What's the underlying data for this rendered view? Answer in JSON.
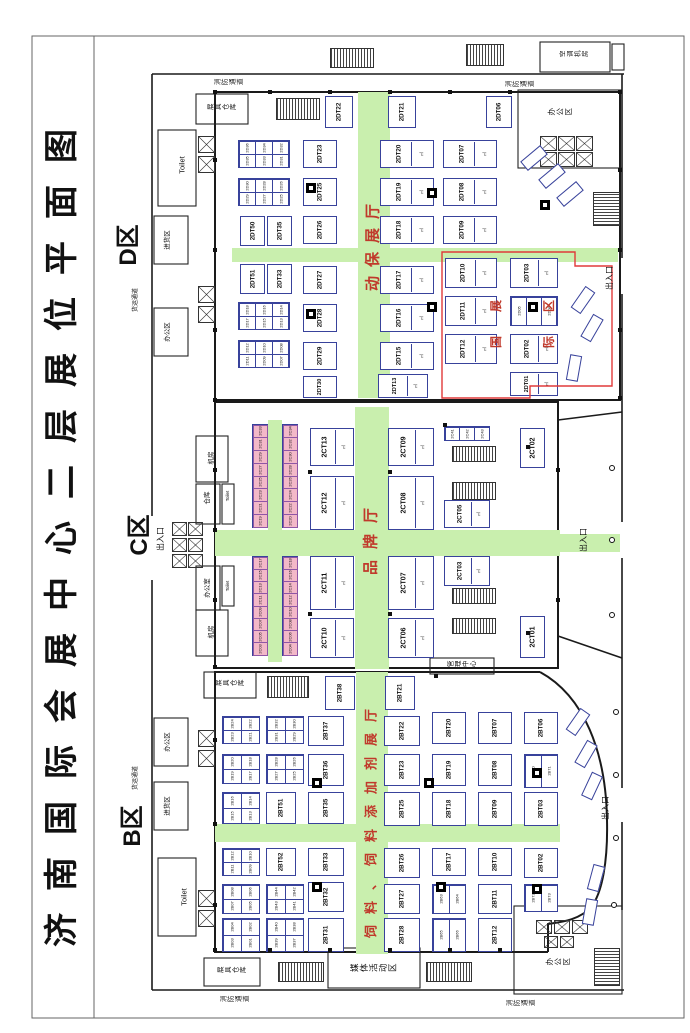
{
  "title": "济南国际会展中心二层展位平面图",
  "zones": {
    "d": {
      "label": "D区",
      "hall": "动保展厅"
    },
    "c": {
      "label": "C区",
      "hall": "品牌厅"
    },
    "b": {
      "label": "B区",
      "hall": "饲料、饲料添加剂展厅"
    },
    "international": {
      "label": "国际展区"
    }
  },
  "colors": {
    "aisle_green": "#c9efae",
    "booth_border": "#38429b",
    "hall_text_red": "#c0392b",
    "intl_box_red": "#e03a3a",
    "mini_pink": "#f3b8c8"
  },
  "booths": [
    [
      "2DT22",
      325,
      96,
      28,
      32
    ],
    [
      "2DT21",
      388,
      96,
      28,
      32
    ],
    [
      "2DT06",
      486,
      96,
      26,
      32
    ],
    [
      "2DT50",
      240,
      216,
      25,
      30
    ],
    [
      "2DT35",
      267,
      216,
      25,
      30
    ],
    [
      "2DT51",
      240,
      264,
      25,
      30
    ],
    [
      "2DT33",
      267,
      264,
      25,
      30
    ],
    [
      "2DT23",
      303,
      140,
      34,
      28
    ],
    [
      "2DT25",
      303,
      178,
      34,
      28
    ],
    [
      "2DT26",
      303,
      216,
      34,
      28
    ],
    [
      "2DT27",
      303,
      266,
      34,
      28
    ],
    [
      "2DT28",
      303,
      304,
      34,
      28
    ],
    [
      "2DT29",
      303,
      342,
      34,
      28
    ],
    [
      "2DT30",
      303,
      376,
      34,
      22
    ],
    [
      "2DT20",
      380,
      140,
      54,
      28
    ],
    [
      "2DT19",
      380,
      178,
      54,
      28
    ],
    [
      "2DT18",
      380,
      216,
      54,
      28
    ],
    [
      "2DT17",
      380,
      266,
      54,
      28
    ],
    [
      "2DT16",
      380,
      304,
      54,
      28
    ],
    [
      "2DT15",
      380,
      342,
      54,
      28
    ],
    [
      "2DT13",
      378,
      374,
      50,
      24
    ],
    [
      "2DT07",
      443,
      140,
      54,
      28
    ],
    [
      "2DT08",
      443,
      178,
      54,
      28
    ],
    [
      "2DT09",
      443,
      216,
      54,
      28
    ],
    [
      "2DT10",
      445,
      258,
      52,
      30
    ],
    [
      "2DT11",
      445,
      296,
      52,
      30
    ],
    [
      "2DT12",
      445,
      334,
      52,
      30
    ],
    [
      "2DT03",
      510,
      258,
      48,
      30
    ],
    [
      "2DT02",
      510,
      334,
      48,
      30
    ],
    [
      "2DT01",
      510,
      372,
      48,
      24
    ],
    [
      "2CT13",
      310,
      428,
      44,
      38
    ],
    [
      "2CT12",
      310,
      476,
      44,
      54
    ],
    [
      "2CT11",
      310,
      556,
      44,
      54
    ],
    [
      "2CT10",
      310,
      618,
      44,
      40
    ],
    [
      "2CT09",
      388,
      428,
      46,
      38
    ],
    [
      "2CT08",
      388,
      476,
      46,
      54
    ],
    [
      "2CT07",
      388,
      556,
      46,
      54
    ],
    [
      "2CT06",
      388,
      618,
      46,
      40
    ],
    [
      "2CT05",
      444,
      500,
      46,
      28
    ],
    [
      "2CT03",
      444,
      556,
      46,
      30
    ],
    [
      "2CT02",
      520,
      428,
      25,
      40
    ],
    [
      "2CT01",
      520,
      616,
      25,
      42
    ],
    [
      "2BT38",
      325,
      676,
      30,
      34
    ],
    [
      "2BT21",
      385,
      676,
      30,
      34
    ],
    [
      "2BT37",
      308,
      716,
      36,
      30
    ],
    [
      "2BT36",
      308,
      754,
      36,
      32
    ],
    [
      "2BT35",
      308,
      792,
      36,
      32
    ],
    [
      "2BT33",
      308,
      848,
      36,
      28
    ],
    [
      "2BT32",
      308,
      882,
      36,
      30
    ],
    [
      "2BT31",
      308,
      918,
      36,
      34
    ],
    [
      "2BT51",
      266,
      792,
      30,
      32
    ],
    [
      "2BT52",
      266,
      848,
      30,
      28
    ],
    [
      "2BT22",
      384,
      716,
      36,
      30
    ],
    [
      "2BT23",
      384,
      754,
      36,
      32
    ],
    [
      "2BT25",
      384,
      792,
      36,
      34
    ],
    [
      "2BT26",
      384,
      848,
      36,
      30
    ],
    [
      "2BT27",
      384,
      884,
      36,
      30
    ],
    [
      "2BT28",
      384,
      918,
      36,
      34
    ],
    [
      "2BT20",
      432,
      712,
      34,
      32
    ],
    [
      "2BT19",
      432,
      754,
      34,
      32
    ],
    [
      "2BT18",
      432,
      792,
      34,
      34
    ],
    [
      "2BT17",
      432,
      848,
      34,
      28
    ],
    [
      "2BT07",
      478,
      712,
      34,
      32
    ],
    [
      "2BT08",
      478,
      754,
      34,
      32
    ],
    [
      "2BT09",
      478,
      792,
      34,
      34
    ],
    [
      "2BT10",
      478,
      848,
      34,
      28
    ],
    [
      "2BT11",
      478,
      884,
      34,
      30
    ],
    [
      "2BT12",
      478,
      918,
      34,
      34
    ],
    [
      "2BT06",
      524,
      712,
      34,
      32
    ],
    [
      "2BT03",
      524,
      792,
      34,
      34
    ],
    [
      "2BT02",
      524,
      848,
      34,
      30
    ]
  ],
  "clusters": [
    {
      "x": 238,
      "y": 140,
      "w": 52,
      "h": 28,
      "c": 3,
      "r": 2,
      "cells": [
        "2D36",
        "2D34",
        "2D32",
        "2D35",
        "2D33",
        "2D31"
      ]
    },
    {
      "x": 238,
      "y": 178,
      "w": 52,
      "h": 28,
      "c": 3,
      "r": 2,
      "cells": [
        "2D30",
        "2D28",
        "2D26",
        "2D29",
        "2D27",
        "2D25"
      ]
    },
    {
      "x": 238,
      "y": 302,
      "w": 52,
      "h": 28,
      "c": 3,
      "r": 2,
      "cells": [
        "2D18",
        "2D16",
        "2D14",
        "2D17",
        "2D15",
        "2D13"
      ]
    },
    {
      "x": 238,
      "y": 340,
      "w": 52,
      "h": 28,
      "c": 3,
      "r": 2,
      "cells": [
        "2D12",
        "2D10",
        "2D08",
        "2D11",
        "2D09",
        "2D07"
      ]
    },
    {
      "x": 510,
      "y": 296,
      "w": 48,
      "h": 30,
      "c": 3,
      "r": 1,
      "cells": [
        "2D05",
        "",
        "2D04"
      ]
    },
    {
      "x": 444,
      "y": 426,
      "w": 46,
      "h": 15,
      "c": 3,
      "r": 1,
      "cells": [
        "2C41",
        "2C42",
        "2C43"
      ]
    },
    {
      "x": 222,
      "y": 716,
      "w": 38,
      "h": 28,
      "c": 2,
      "r": 2,
      "cells": [
        "2B24",
        "2B22",
        "2B23",
        "2B21"
      ]
    },
    {
      "x": 222,
      "y": 754,
      "w": 38,
      "h": 30,
      "c": 2,
      "r": 2,
      "cells": [
        "2B20",
        "2B18",
        "2B19",
        "2B17"
      ]
    },
    {
      "x": 222,
      "y": 792,
      "w": 38,
      "h": 32,
      "c": 2,
      "r": 2,
      "cells": [
        "2B16",
        "2B14",
        "2B15",
        "2B13"
      ]
    },
    {
      "x": 222,
      "y": 848,
      "w": 38,
      "h": 28,
      "c": 2,
      "r": 2,
      "cells": [
        "2B12",
        "2B10",
        "2B11",
        "2B09"
      ]
    },
    {
      "x": 222,
      "y": 884,
      "w": 38,
      "h": 30,
      "c": 2,
      "r": 2,
      "cells": [
        "2B08",
        "2B06",
        "2B07",
        "2B05"
      ]
    },
    {
      "x": 222,
      "y": 918,
      "w": 38,
      "h": 34,
      "c": 2,
      "r": 2,
      "cells": [
        "2B04",
        "2B02",
        "2B03",
        "2B01"
      ]
    },
    {
      "x": 266,
      "y": 716,
      "w": 38,
      "h": 28,
      "c": 2,
      "r": 2,
      "cells": [
        "2B32",
        "2B30",
        "2B31",
        "2B29"
      ]
    },
    {
      "x": 266,
      "y": 754,
      "w": 38,
      "h": 30,
      "c": 2,
      "r": 2,
      "cells": [
        "2B28",
        "2B26",
        "2B27",
        "2B25"
      ]
    },
    {
      "x": 266,
      "y": 884,
      "w": 38,
      "h": 30,
      "c": 2,
      "r": 2,
      "cells": [
        "2B44",
        "2B42",
        "2B43",
        "2B41"
      ]
    },
    {
      "x": 266,
      "y": 918,
      "w": 38,
      "h": 34,
      "c": 2,
      "r": 2,
      "cells": [
        "2B40",
        "2B38",
        "2B39",
        "2B37"
      ]
    },
    {
      "x": 432,
      "y": 884,
      "w": 34,
      "h": 30,
      "c": 2,
      "r": 1,
      "cells": [
        "2B63",
        "2B64"
      ]
    },
    {
      "x": 432,
      "y": 918,
      "w": 34,
      "h": 34,
      "c": 2,
      "r": 1,
      "cells": [
        "2B65",
        "2B66"
      ]
    },
    {
      "x": 524,
      "y": 754,
      "w": 34,
      "h": 34,
      "c": 2,
      "r": 1,
      "cells": [
        "2B70",
        "2B71"
      ]
    },
    {
      "x": 524,
      "y": 884,
      "w": 34,
      "h": 28,
      "c": 2,
      "r": 1,
      "cells": [
        "2B72",
        "2B73"
      ]
    },
    {
      "x": 252,
      "y": 424,
      "w": 16,
      "h": 104,
      "c": 1,
      "r": 8,
      "pink": 1,
      "cells": [
        "2C33",
        "2C31",
        "2C29",
        "2C27",
        "2C25",
        "2C23",
        "2C21",
        "2C19"
      ]
    },
    {
      "x": 282,
      "y": 424,
      "w": 16,
      "h": 104,
      "c": 1,
      "r": 8,
      "pink": 1,
      "cells": [
        "2C34",
        "2C32",
        "2C30",
        "2C28",
        "2C26",
        "2C24",
        "2C22",
        "2C20"
      ]
    },
    {
      "x": 252,
      "y": 556,
      "w": 16,
      "h": 100,
      "c": 1,
      "r": 8,
      "pink": 1,
      "cells": [
        "2C17",
        "2C15",
        "2C13",
        "2C11",
        "2C09",
        "2C07",
        "2C05",
        "2C03"
      ]
    },
    {
      "x": 282,
      "y": 556,
      "w": 16,
      "h": 100,
      "c": 1,
      "r": 8,
      "pink": 1,
      "cells": [
        "2C18",
        "2C16",
        "2C14",
        "2C12",
        "2C10",
        "2C08",
        "2C06",
        "2C04"
      ]
    }
  ],
  "hall_texts": [
    {
      "t": "动保展厅",
      "x": 373,
      "y": 243,
      "fs": 15,
      "ls": 9
    },
    {
      "t": "品牌厅",
      "x": 371,
      "y": 536,
      "fs": 15,
      "ls": 11
    },
    {
      "t": "饲料、饲料添加剂展厅",
      "x": 371,
      "y": 818,
      "fs": 13,
      "ls": 11
    },
    {
      "t": "国展",
      "x": 496,
      "y": 312,
      "fs": 12,
      "ls": 24
    },
    {
      "t": "际区",
      "x": 549,
      "y": 312,
      "fs": 12,
      "ls": 24
    }
  ],
  "labels": [
    {
      "t": "消防通道",
      "x": 229,
      "y": 84,
      "fs": 6.5,
      "m": "h"
    },
    {
      "t": "消防通道",
      "x": 520,
      "y": 86,
      "fs": 6.5,
      "m": "h"
    },
    {
      "t": "消防通道",
      "x": 235,
      "y": 1001,
      "fs": 6.5,
      "m": "h"
    },
    {
      "t": "消防通道",
      "x": 521,
      "y": 1005,
      "fs": 6.5,
      "m": "h"
    },
    {
      "t": "展具仓库",
      "x": 222,
      "y": 109,
      "fs": 6.5,
      "m": "h"
    },
    {
      "t": "展具仓库",
      "x": 230,
      "y": 685,
      "fs": 6.5,
      "m": "h"
    },
    {
      "t": "展具仓库",
      "x": 232,
      "y": 972,
      "fs": 6.5,
      "m": "h"
    },
    {
      "t": "Toilet",
      "x": 182,
      "y": 165,
      "fs": 7.5,
      "m": "v"
    },
    {
      "t": "Toilet",
      "x": 184,
      "y": 897,
      "fs": 7.5,
      "m": "v"
    },
    {
      "t": "D区",
      "x": 129,
      "y": 245,
      "fs": 24,
      "m": "v",
      "b": 1
    },
    {
      "t": "C区",
      "x": 140,
      "y": 535,
      "fs": 24,
      "m": "v",
      "b": 1
    },
    {
      "t": "B区",
      "x": 133,
      "y": 826,
      "fs": 24,
      "m": "v",
      "b": 1
    },
    {
      "t": "出入口",
      "x": 161,
      "y": 539,
      "fs": 8,
      "m": "v"
    },
    {
      "t": "出入口",
      "x": 610,
      "y": 278,
      "fs": 8,
      "m": "v"
    },
    {
      "t": "出入口",
      "x": 584,
      "y": 540,
      "fs": 8,
      "m": "v"
    },
    {
      "t": "出入口",
      "x": 606,
      "y": 808,
      "fs": 8,
      "m": "v"
    },
    {
      "t": "货运通道",
      "x": 136,
      "y": 300,
      "fs": 6,
      "m": "v"
    },
    {
      "t": "货运通道",
      "x": 136,
      "y": 778,
      "fs": 6,
      "m": "v"
    },
    {
      "t": "进货区",
      "x": 168,
      "y": 240,
      "fs": 6.5,
      "m": "v"
    },
    {
      "t": "进货区",
      "x": 168,
      "y": 806,
      "fs": 6.5,
      "m": "v"
    },
    {
      "t": "办公区",
      "x": 168,
      "y": 332,
      "fs": 6.5,
      "m": "v"
    },
    {
      "t": "办公区",
      "x": 168,
      "y": 742,
      "fs": 6.5,
      "m": "v"
    },
    {
      "t": "办公区",
      "x": 560,
      "y": 112,
      "fs": 7.5,
      "m": "h"
    },
    {
      "t": "办公区",
      "x": 558,
      "y": 962,
      "fs": 7.5,
      "m": "h"
    },
    {
      "t": "空调机房",
      "x": 574,
      "y": 56,
      "fs": 6.5,
      "m": "h"
    },
    {
      "t": "机房",
      "x": 212,
      "y": 458,
      "fs": 6.5,
      "m": "v"
    },
    {
      "t": "仓库",
      "x": 208,
      "y": 498,
      "fs": 6.5,
      "m": "v"
    },
    {
      "t": "Toilet",
      "x": 228,
      "y": 496,
      "fs": 4.5,
      "m": "v"
    },
    {
      "t": "办公室",
      "x": 208,
      "y": 588,
      "fs": 6.5,
      "m": "v"
    },
    {
      "t": "Toilet",
      "x": 228,
      "y": 586,
      "fs": 4.5,
      "m": "v"
    },
    {
      "t": "机房",
      "x": 212,
      "y": 632,
      "fs": 6.5,
      "m": "v"
    },
    {
      "t": "管理中心",
      "x": 462,
      "y": 666,
      "fs": 6.5,
      "m": "h"
    },
    {
      "t": "媒体活动区",
      "x": 374,
      "y": 968,
      "fs": 8.5,
      "m": "h"
    }
  ],
  "black_squares": [
    [
      306,
      183
    ],
    [
      306,
      309
    ],
    [
      427,
      188
    ],
    [
      427,
      302
    ],
    [
      528,
      302
    ],
    [
      540,
      200
    ],
    [
      312,
      778
    ],
    [
      424,
      778
    ],
    [
      312,
      882
    ],
    [
      436,
      882
    ],
    [
      532,
      768
    ],
    [
      532,
      884
    ]
  ]
}
